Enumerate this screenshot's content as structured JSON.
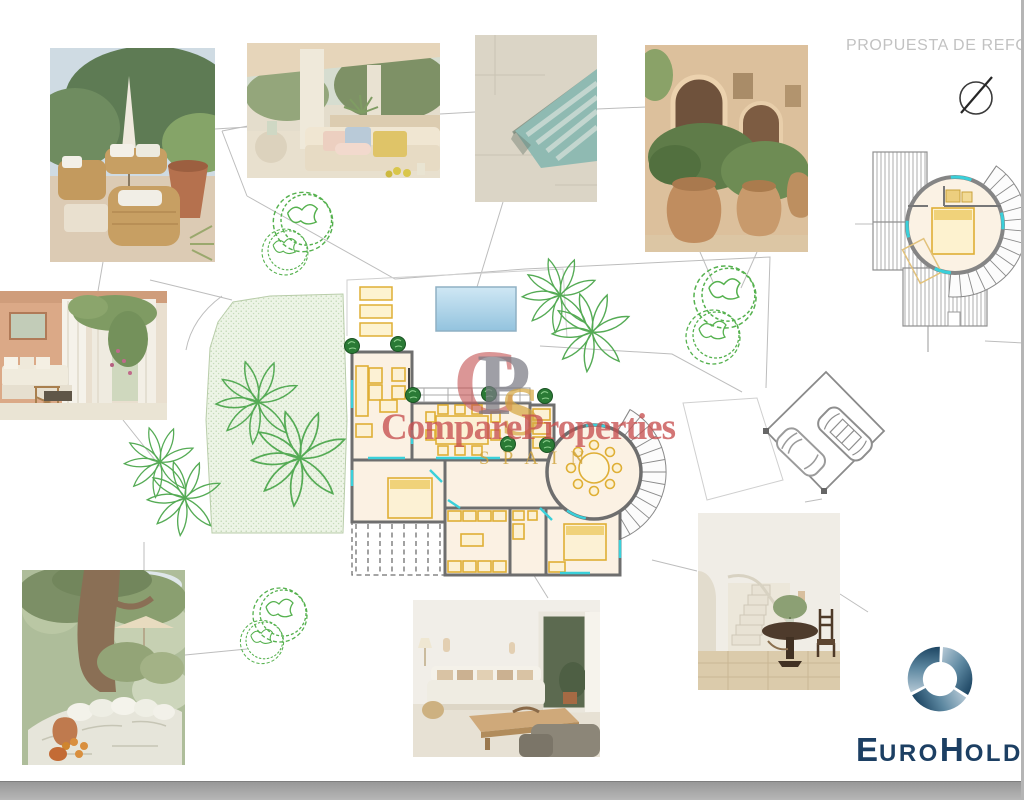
{
  "header": {
    "title": "PROPUESTA DE REFORM"
  },
  "compass": {
    "icon": "north-arrow-icon"
  },
  "watermark": {
    "monogram_c": "C",
    "monogram_p": "P",
    "monogram_s": "S",
    "brand": "CompareProperties",
    "country": "SPAIN",
    "brand_color": "#c65050",
    "gold_color": "#d5a842"
  },
  "logo": {
    "name": "EuroHolding",
    "e": "E",
    "uro": "URO",
    "h": "H",
    "olding": "OLDING",
    "navy": "#1c3f63",
    "icon": "swirl-globe-icon"
  },
  "photos": [
    {
      "id": "terrace-lounge",
      "description": "Outdoor terrace with wicker lounge furniture, white cushions and closed parasol"
    },
    {
      "id": "covered-terrace",
      "description": "Covered terrace sofa with patterned cushions among olive trees and agave"
    },
    {
      "id": "pool-steps",
      "description": "Pool corner with submerged steps and beige stone deck"
    },
    {
      "id": "terracotta-pots",
      "description": "Large terracotta urns with clipped shrubs by an arched facade"
    },
    {
      "id": "porch-curtains",
      "description": "Porch with white curtains, climbing bougainvillea and white sofa"
    },
    {
      "id": "olive-tree-bench",
      "description": "Olive tree over whitewashed stone bench with cushions and oranges"
    },
    {
      "id": "living-room",
      "description": "White living room with linen sofa, cushions and wooden coffee table"
    },
    {
      "id": "staircase-hall",
      "description": "Hallway with curved staircase, round pedestal table and wooden chair"
    }
  ],
  "plan": {
    "site": {
      "lawn": "stippled lawn area with palm trees",
      "pool": "rectangular pool with three sun loungers",
      "parking": "angled parking bay with two cars",
      "vegetation": [
        "palm trees",
        "round canopy trees",
        "clipped bushes"
      ]
    },
    "main_floor": {
      "rooms": [
        "living room",
        "dining room",
        "kitchen",
        "bathroom",
        "bedroom",
        "bedroom",
        "circular dining tower",
        "pergola terrace"
      ],
      "circular_room_seats": 8
    },
    "tower_detail": {
      "features": [
        "circular bedroom",
        "double bed",
        "external spiral staircase",
        "hatched roof planes"
      ]
    },
    "colors": {
      "wall": "#6e6e6e",
      "room_fill": "#fbf1e3",
      "furniture": "#dfaf35",
      "glazing": "#3ad0da",
      "vegetation": "#55b14e",
      "lawn_fill": "#edf4e6",
      "pool_fill": "#a9cfe6",
      "bottom_bar": "#a9a9a9"
    }
  }
}
